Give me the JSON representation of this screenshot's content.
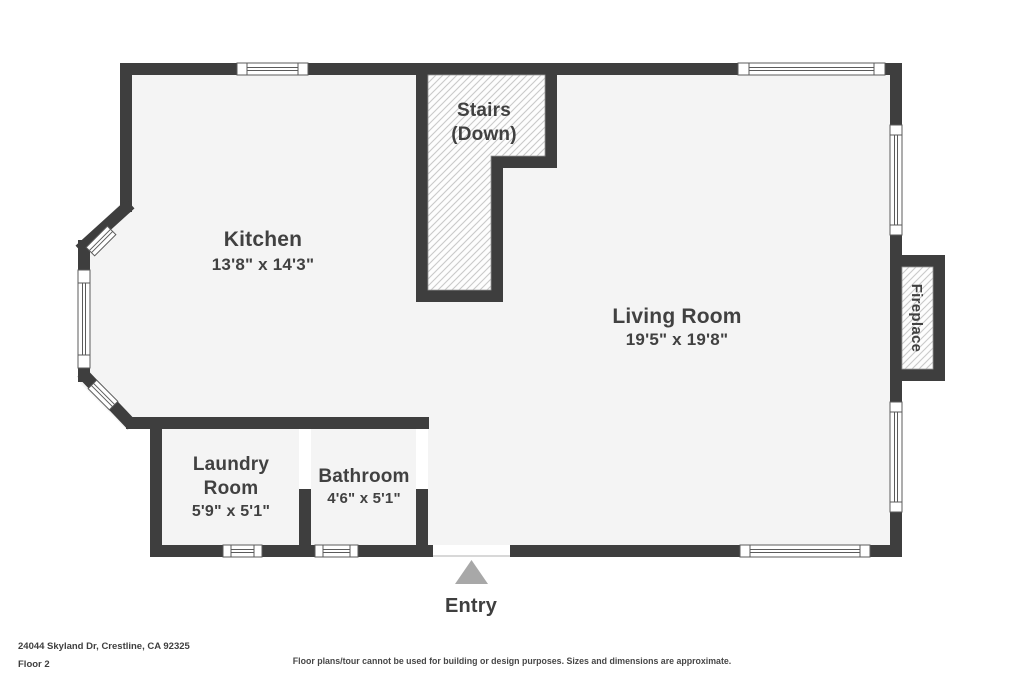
{
  "plan": {
    "kitchen": {
      "name": "Kitchen",
      "dims": "13'8\" x 14'3\""
    },
    "living_room": {
      "name": "Living Room",
      "dims": "19'5\" x 19'8\""
    },
    "stairs": {
      "line1": "Stairs",
      "line2": "(Down)"
    },
    "laundry_room": {
      "line1": "Laundry",
      "line2": "Room",
      "dims": "5'9\" x 5'1\""
    },
    "bathroom": {
      "name": "Bathroom",
      "dims": "4'6\" x 5'1\""
    },
    "fireplace": {
      "label": "Fireplace"
    },
    "entry": {
      "label": "Entry"
    }
  },
  "footer": {
    "address": "24044 Skyland Dr, Crestline, CA 92325",
    "floor": "Floor 2",
    "disclaimer": "Floor plans/tour cannot be used for building or design purposes. Sizes and dimensions are approximate."
  },
  "colors": {
    "wall": "#3e3e3e",
    "floor": "#f4f4f4",
    "hatch_line": "#c9c9c9",
    "text": "#414141",
    "entry_arrow": "#a8a8a8",
    "background": "#ffffff"
  }
}
